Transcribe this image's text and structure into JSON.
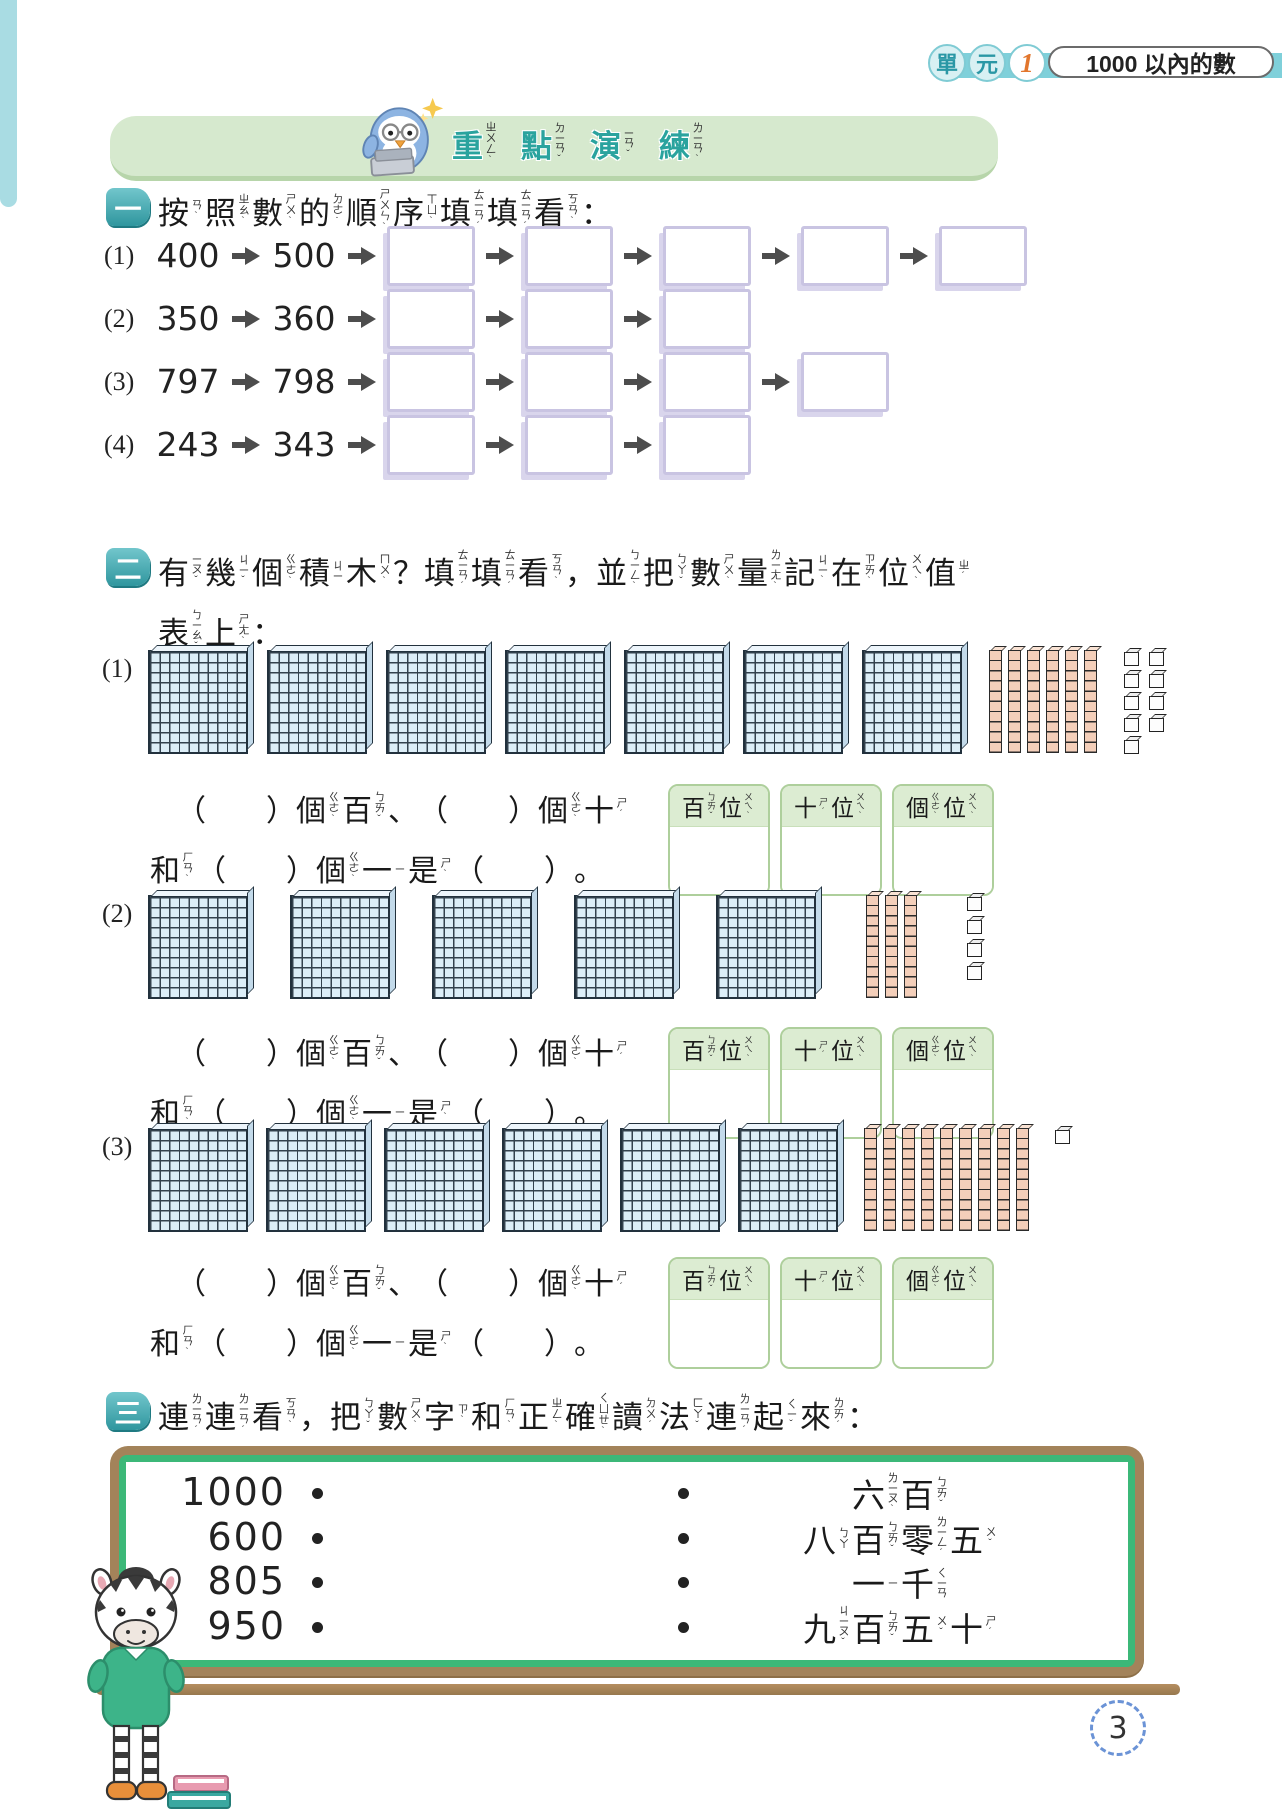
{
  "page": {
    "number": "3"
  },
  "unit_badge": {
    "char1": "單",
    "char2": "元",
    "num": "1",
    "title": "1000 以內的數"
  },
  "banner": {
    "title": [
      [
        "重",
        "ㄓㄨㄥˋ"
      ],
      [
        "點",
        "ㄉㄧㄢˇ"
      ],
      [
        "演",
        "ㄧㄢˇ"
      ],
      [
        "練",
        "ㄌㄧㄢˋ"
      ]
    ]
  },
  "section1": {
    "badge": "一",
    "heading": [
      [
        "按",
        "ㄢˋ"
      ],
      [
        "照",
        "ㄓㄠˋ"
      ],
      [
        "數",
        "ㄕㄨˋ"
      ],
      [
        "的",
        "ㄉㄜ˙"
      ],
      [
        "順",
        "ㄕㄨㄣˋ"
      ],
      [
        "序",
        "ㄒㄩˋ"
      ],
      [
        "填",
        "ㄊㄧㄢˊ"
      ],
      [
        "填",
        "ㄊㄧㄢˊ"
      ],
      [
        "看",
        "ㄎㄢˋ"
      ],
      "："
    ],
    "rows": [
      {
        "label": "(1)",
        "numbers": [
          "400",
          "500"
        ],
        "blank_boxes": 5
      },
      {
        "label": "(2)",
        "numbers": [
          "350",
          "360"
        ],
        "blank_boxes": 3
      },
      {
        "label": "(3)",
        "numbers": [
          "797",
          "798"
        ],
        "blank_boxes": 4
      },
      {
        "label": "(4)",
        "numbers": [
          "243",
          "343"
        ],
        "blank_boxes": 3
      }
    ]
  },
  "section2": {
    "badge": "二",
    "heading_line1": [
      [
        "有",
        "ㄧㄡˇ"
      ],
      [
        "幾",
        "ㄐㄧˇ"
      ],
      [
        "個",
        "ㄍㄜˋ"
      ],
      [
        "積",
        "ㄐㄧ"
      ],
      [
        "木",
        "ㄇㄨˋ"
      ],
      "？",
      [
        "填",
        "ㄊㄧㄢˊ"
      ],
      [
        "填",
        "ㄊㄧㄢˊ"
      ],
      [
        "看",
        "ㄎㄢˋ"
      ],
      "，",
      [
        "並",
        "ㄅㄧㄥˋ"
      ],
      [
        "把",
        "ㄅㄚˇ"
      ],
      [
        "數",
        "ㄕㄨˋ"
      ],
      [
        "量",
        "ㄌㄧㄤˋ"
      ],
      [
        "記",
        "ㄐㄧˋ"
      ],
      [
        "在",
        "ㄗㄞˋ"
      ],
      [
        "位",
        "ㄨㄟˋ"
      ],
      [
        "值",
        "ㄓˊ"
      ]
    ],
    "heading_line2": [
      [
        "表",
        "ㄅㄧㄠˇ"
      ],
      [
        "上",
        "ㄕㄤˋ"
      ],
      "："
    ],
    "answer_line1": [
      "（　　）",
      [
        "個",
        "ㄍㄜˋ"
      ],
      [
        "百",
        "ㄅㄞˇ"
      ],
      "、",
      "（　　）",
      [
        "個",
        "ㄍㄜˋ"
      ],
      [
        "十",
        "ㄕˊ"
      ]
    ],
    "answer_line2": [
      [
        "和",
        "ㄏㄢˋ"
      ],
      "（　　）",
      [
        "個",
        "ㄍㄜˋ"
      ],
      [
        "一",
        "ㄧ"
      ],
      [
        "是",
        "ㄕˋ"
      ],
      "（　　）",
      "。"
    ],
    "place_value_headers": [
      [
        [
          "百",
          "ㄅㄞˇ"
        ],
        [
          "位",
          "ㄨㄟˋ"
        ]
      ],
      [
        [
          "十",
          "ㄕˊ"
        ],
        [
          "位",
          "ㄨㄟˋ"
        ]
      ],
      [
        [
          "個",
          "ㄍㄜˋ"
        ],
        [
          "位",
          "ㄨㄟˋ"
        ]
      ]
    ],
    "problems": [
      {
        "label": "(1)",
        "hundreds": 7,
        "tens": 6,
        "ones": 9,
        "ones_layout": "grid"
      },
      {
        "label": "(2)",
        "hundreds": 5,
        "tens": 3,
        "ones": 4,
        "ones_layout": "column"
      },
      {
        "label": "(3)",
        "hundreds": 6,
        "tens": 9,
        "ones": 1,
        "ones_layout": "single"
      }
    ]
  },
  "section3": {
    "badge": "三",
    "heading": [
      [
        "連",
        "ㄌㄧㄢˊ"
      ],
      [
        "連",
        "ㄌㄧㄢˊ"
      ],
      [
        "看",
        "ㄎㄢˋ"
      ],
      "，",
      [
        "把",
        "ㄅㄚˇ"
      ],
      [
        "數",
        "ㄕㄨˋ"
      ],
      [
        "字",
        "ㄗˋ"
      ],
      [
        "和",
        "ㄏㄢˋ"
      ],
      [
        "正",
        "ㄓㄥˋ"
      ],
      [
        "確",
        "ㄑㄩㄝˋ"
      ],
      [
        "讀",
        "ㄉㄨˊ"
      ],
      [
        "法",
        "ㄈㄚˇ"
      ],
      [
        "連",
        "ㄌㄧㄢˊ"
      ],
      [
        "起",
        "ㄑㄧˇ"
      ],
      [
        "來",
        "ㄌㄞˊ"
      ],
      "："
    ],
    "board": {
      "numbers": [
        "1000",
        "600",
        "805",
        "950"
      ],
      "readings": [
        [
          [
            "六",
            "ㄌㄧㄡˋ"
          ],
          [
            "百",
            "ㄅㄞˇ"
          ]
        ],
        [
          [
            "八",
            "ㄅㄚ"
          ],
          [
            "百",
            "ㄅㄞˇ"
          ],
          [
            "零",
            "ㄌㄧㄥˊ"
          ],
          [
            "五",
            "ㄨˇ"
          ]
        ],
        [
          [
            "一",
            "ㄧ"
          ],
          [
            "千",
            "ㄑㄧㄢ"
          ]
        ],
        [
          [
            "九",
            "ㄐㄧㄡˇ"
          ],
          [
            "百",
            "ㄅㄞˇ"
          ],
          [
            "五",
            "ㄨˇ"
          ],
          [
            "十",
            "ㄕˊ"
          ]
        ]
      ]
    }
  },
  "colors": {
    "accent_teal": "#2f969e",
    "banner_green": "#d6e9ce",
    "cyan_bar": "#7fd0da",
    "blank_box_border": "#c9c4e2",
    "hundred_block_blue": "#dceef8",
    "rod_pink": "#f4cfba",
    "table_header_green": "#dcecd2",
    "table_border_green": "#aecf9c",
    "board_frame_brown": "#a3835a",
    "board_border_green": "#3cb878",
    "arrow_gray": "#4d4d4d",
    "page_circle_blue": "#6b93d6"
  }
}
